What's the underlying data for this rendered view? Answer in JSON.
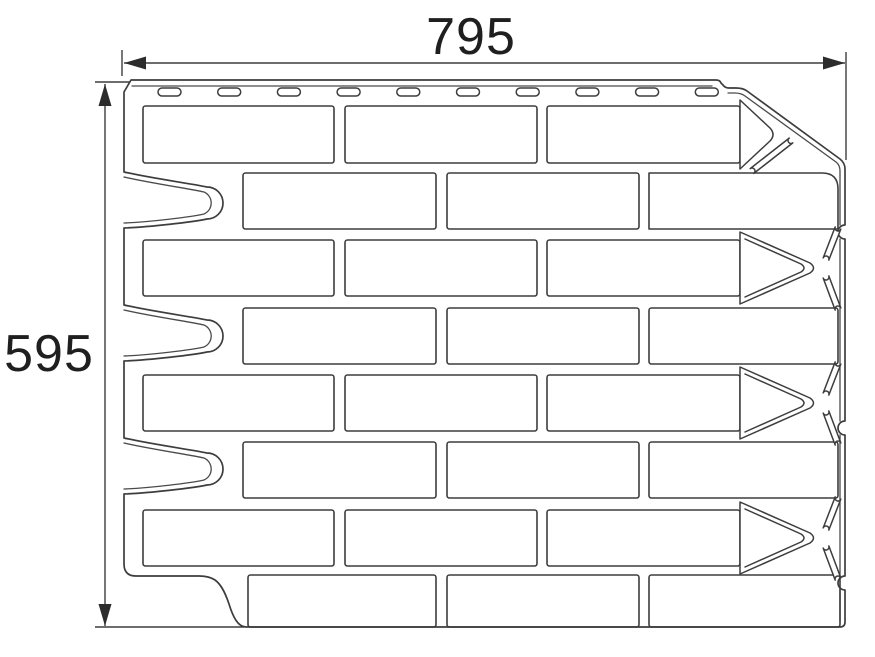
{
  "drawing": {
    "kind": "facade-panel-technical-drawing",
    "background": "#ffffff"
  },
  "colors": {
    "line": "#3d3d3d",
    "inner_line": "#4a4a4a",
    "arrow": "#2c2c2c",
    "text": "#1f1f1f"
  },
  "dimensions": {
    "top_label": "795",
    "left_label": "595"
  },
  "panel": {
    "nail_slots": {
      "count": 10,
      "start_x": 158,
      "pitch": 59.7,
      "y": 88,
      "slot_width": 23,
      "slot_height": 8,
      "corner_radius": 4
    },
    "brick_rows": [
      {
        "y": 106,
        "h": 57,
        "bricks": [
          [
            143,
            191
          ],
          [
            345,
            192
          ],
          [
            547,
            193
          ]
        ],
        "right_end": "corner-triangle"
      },
      {
        "y": 173,
        "h": 56,
        "bricks": [
          [
            243,
            193
          ],
          [
            447,
            192
          ],
          [
            649,
            189
          ]
        ],
        "right_end": "edge"
      },
      {
        "y": 240,
        "h": 56,
        "bricks": [
          [
            143,
            191
          ],
          [
            345,
            192
          ],
          [
            547,
            193
          ]
        ],
        "right_end": "triangle"
      },
      {
        "y": 308,
        "h": 56,
        "bricks": [
          [
            243,
            193
          ],
          [
            447,
            192
          ],
          [
            649,
            189
          ]
        ],
        "right_end": "edge"
      },
      {
        "y": 375,
        "h": 56,
        "bricks": [
          [
            143,
            191
          ],
          [
            345,
            192
          ],
          [
            547,
            193
          ]
        ],
        "right_end": "triangle"
      },
      {
        "y": 442,
        "h": 56,
        "bricks": [
          [
            243,
            193
          ],
          [
            447,
            192
          ],
          [
            649,
            189
          ]
        ],
        "right_end": "edge"
      },
      {
        "y": 510,
        "h": 56,
        "bricks": [
          [
            143,
            191
          ],
          [
            345,
            192
          ],
          [
            547,
            193
          ]
        ],
        "right_end": "triangle"
      },
      {
        "y": 575,
        "h": 52,
        "bricks": [
          [
            248,
            188
          ],
          [
            447,
            192
          ],
          [
            649,
            191
          ]
        ],
        "right_end": "edge"
      }
    ]
  }
}
